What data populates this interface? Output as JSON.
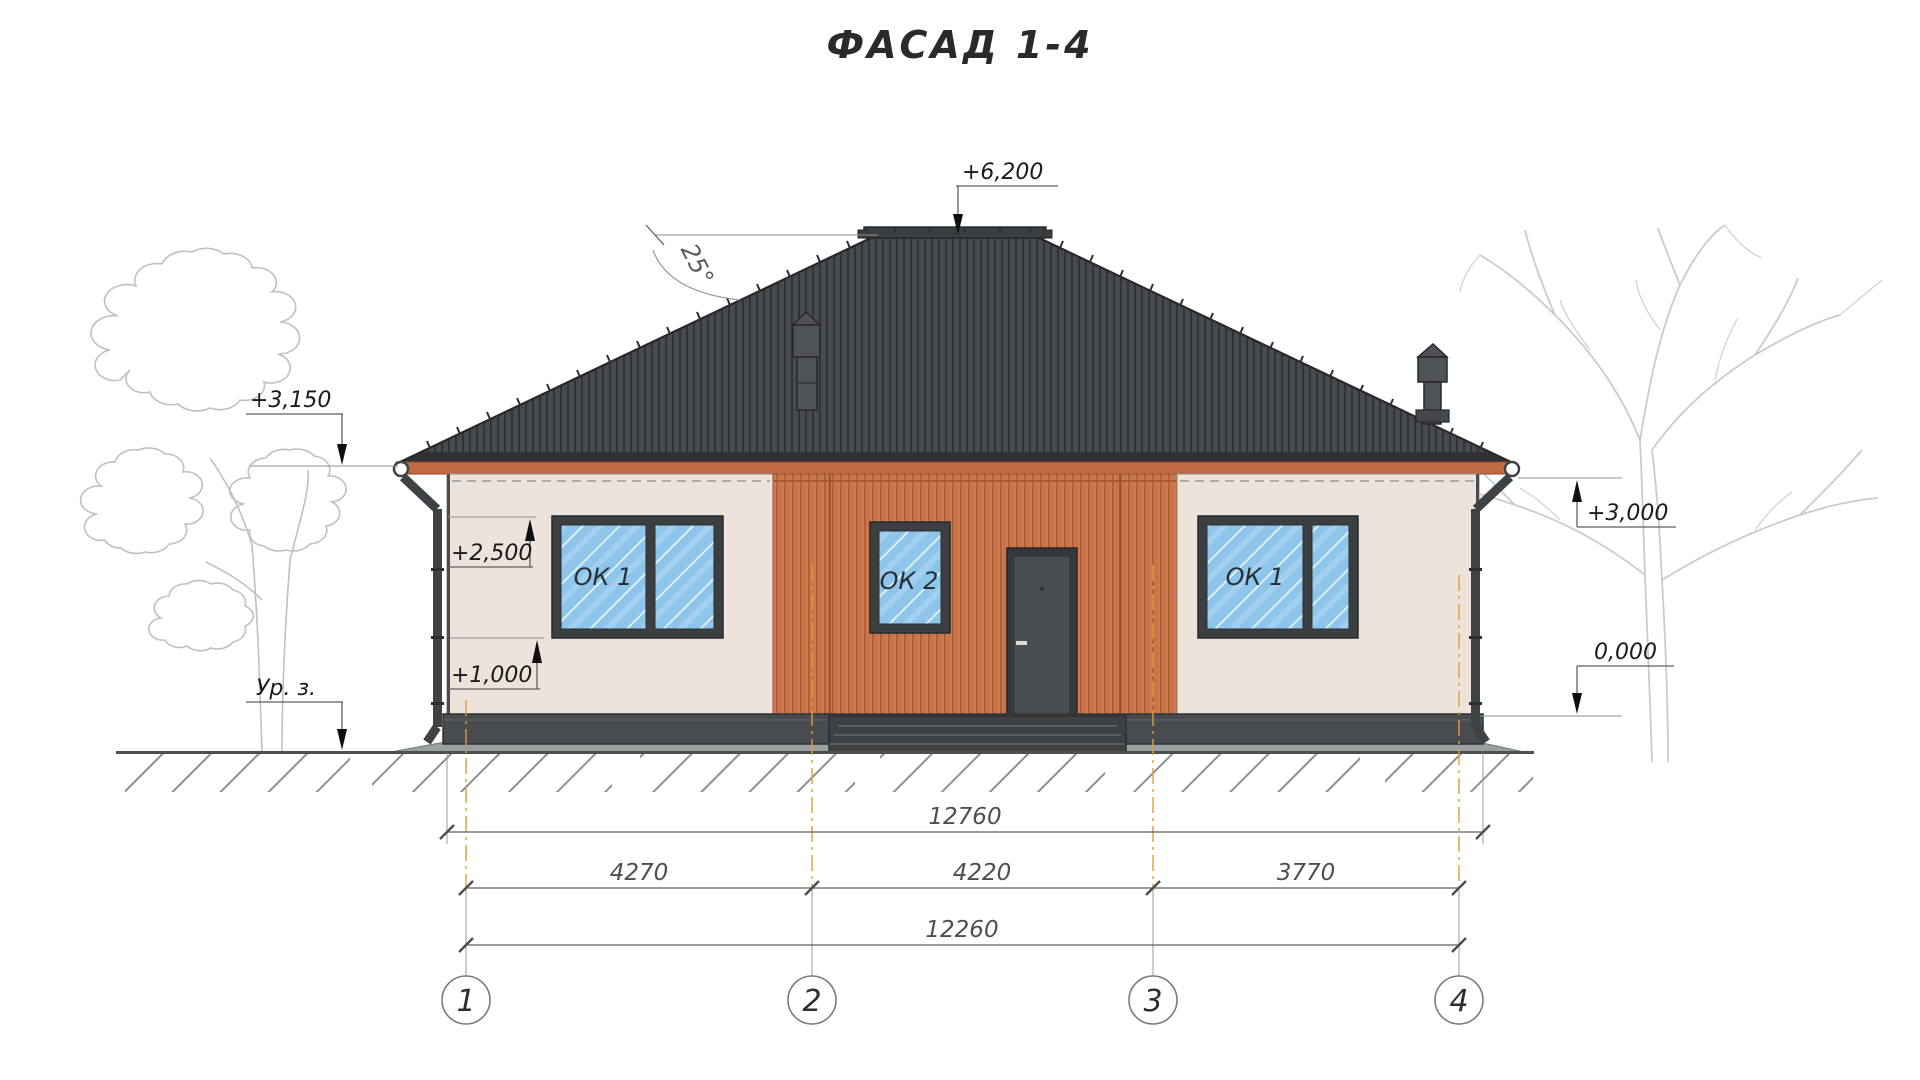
{
  "title": "ФАСАД 1-4",
  "roof": {
    "angle_label": "25°"
  },
  "elevations": {
    "ridge": "+6,200",
    "left_eave": "+3,150",
    "right_eave": "+3,000",
    "window_top": "+2,500",
    "window_sill": "+1,000",
    "floor": "0,000",
    "ground_label": "Ур. з."
  },
  "windows": {
    "left": "ОК 1",
    "center": "ОК 2",
    "right": "ОК 1"
  },
  "dimensions": {
    "overall_top": "12760",
    "span_1_2": "4270",
    "span_2_3": "4220",
    "span_3_4": "3770",
    "overall_axes": "12260"
  },
  "axes": {
    "a1": "1",
    "a2": "2",
    "a3": "3",
    "a4": "4"
  },
  "colors": {
    "roof": "#474a4e",
    "roof_rib": "#2e3134",
    "fascia": "#c06a42",
    "wall_beige": "#ede3da",
    "siding_orange": "#cd7a50",
    "glass_blue": "#8dc6ea",
    "frame_dark": "#3c3f42",
    "plinth": "#494c4e",
    "axis_orange": "#e39b3a"
  }
}
